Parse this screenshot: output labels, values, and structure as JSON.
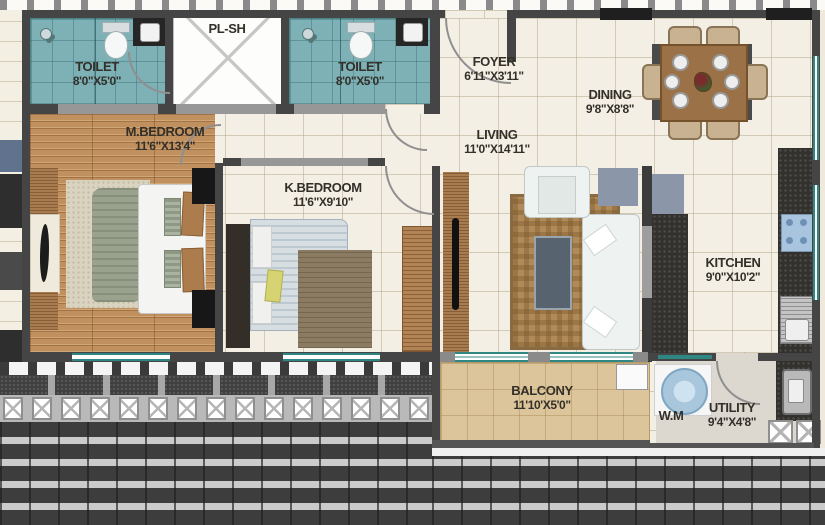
{
  "plan_title": "2BHK apartment floor plan",
  "rooms": {
    "toilet1": {
      "label": "TOILET",
      "dims": "8'0\"X5'0\""
    },
    "plsh": {
      "label": "PL-SH",
      "dims": ""
    },
    "toilet2": {
      "label": "TOILET",
      "dims": "8'0\"X5'0\""
    },
    "foyer": {
      "label": "FOYER",
      "dims": "6'11\"X3'11\""
    },
    "dining": {
      "label": "DINING",
      "dims": "9'8\"X8'8\""
    },
    "mbedroom": {
      "label": "M.BEDROOM",
      "dims": "11'6\"X13'4\""
    },
    "kbedroom": {
      "label": "K.BEDROOM",
      "dims": "11'6\"X9'10\""
    },
    "living": {
      "label": "LIVING",
      "dims": "11'0\"X14'11\""
    },
    "kitchen": {
      "label": "KITCHEN",
      "dims": "9'0\"X10'2\""
    },
    "balcony": {
      "label": "BALCONY",
      "dims": "11'10'X5'0\""
    },
    "utility": {
      "label": "UTILITY",
      "dims": "9'4\"X4'8\""
    },
    "wm": {
      "label": "W.M",
      "dims": ""
    }
  },
  "palette": {
    "toilet_floor": "#7db1b5",
    "wood_floor": "#c0905e",
    "balcony_floor": "#dcc59a",
    "tile_floor": "#f4efe4",
    "wall": "#454545",
    "granite_counter": "#33312d",
    "window_frame": "#2e8782",
    "label_text": "#332f29"
  }
}
